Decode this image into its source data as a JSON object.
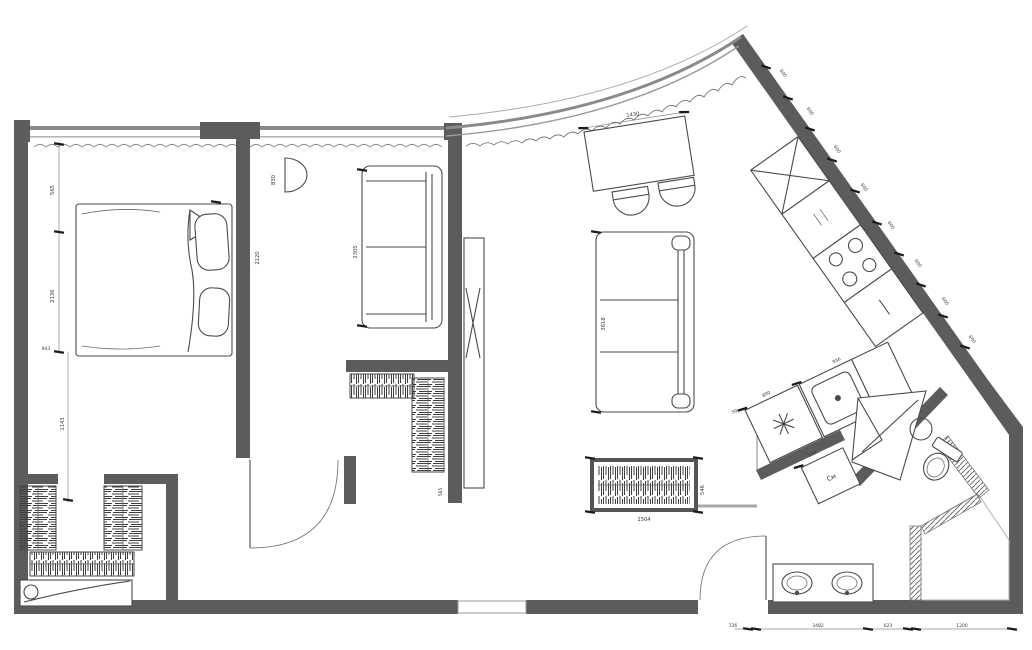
{
  "colors": {
    "wall": "#5c5c5c",
    "furniture_line": "#4a4a4a",
    "dimension_text": "#3a3a3a",
    "hatch": "#555555",
    "background": "#ffffff"
  },
  "icons": {
    "tv_icon": "✕",
    "appliance_star_icon": "✳",
    "cabinet_cross_icon": "✕"
  },
  "appliances": {
    "washing_machine_label": "См"
  },
  "dims": {
    "left": [
      "565",
      "2136",
      "843",
      "1143"
    ],
    "bottom": [
      "726",
      "3482",
      "623",
      "1200"
    ],
    "kitchen_modules": [
      "600",
      "600",
      "600",
      "600",
      "600",
      "600",
      "600",
      "600"
    ],
    "bed_depth": "2120",
    "sofa_small": "2305",
    "basin_niche": "830",
    "sofa_large": "3618",
    "sideboard_len": "1504",
    "sideboard_depth": "546",
    "closet": "565",
    "table": "1430",
    "counter_run": "936",
    "laundry_run": "890",
    "gap": "50",
    "washer": "530"
  }
}
